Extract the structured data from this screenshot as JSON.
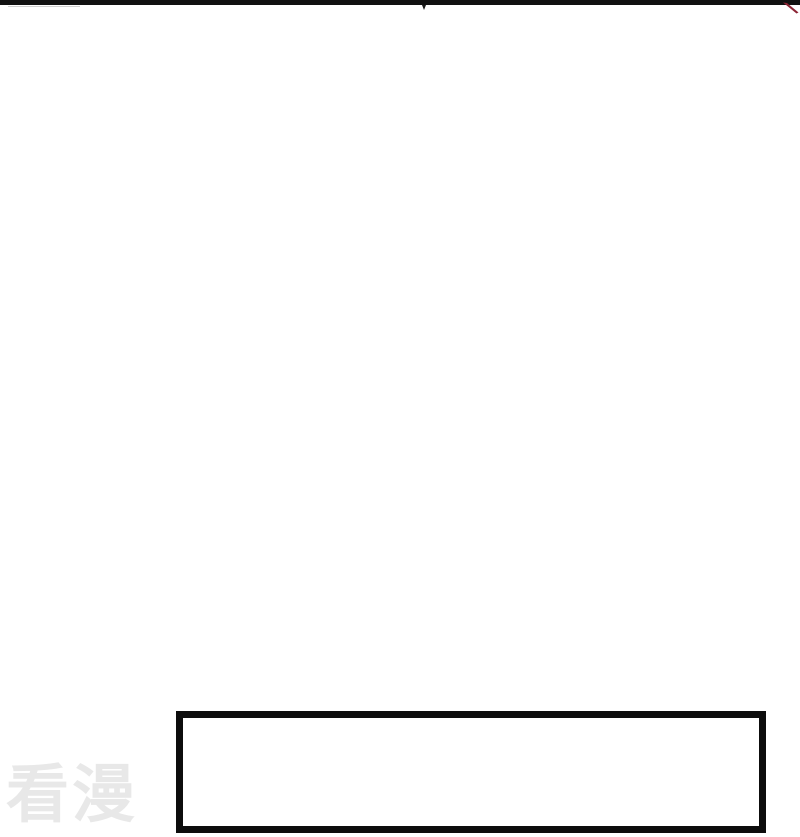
{
  "comic_page": {
    "background_color": "#ffffff",
    "top_border": {
      "description": "black panel edge strip across full top width",
      "color": "#111111",
      "notch_color": "#1a1a1a",
      "faint_line_color": "#cfcfcf"
    },
    "red_ink_stroke": {
      "description": "small dark-red diagonal art stroke at top-right corner",
      "color": "#8b2434"
    },
    "caption_box": {
      "text": "",
      "border_color": "#0d0d0d",
      "fill_color": "#ffffff"
    },
    "watermark": {
      "text": "看漫",
      "color": "#e8e8e8"
    }
  }
}
